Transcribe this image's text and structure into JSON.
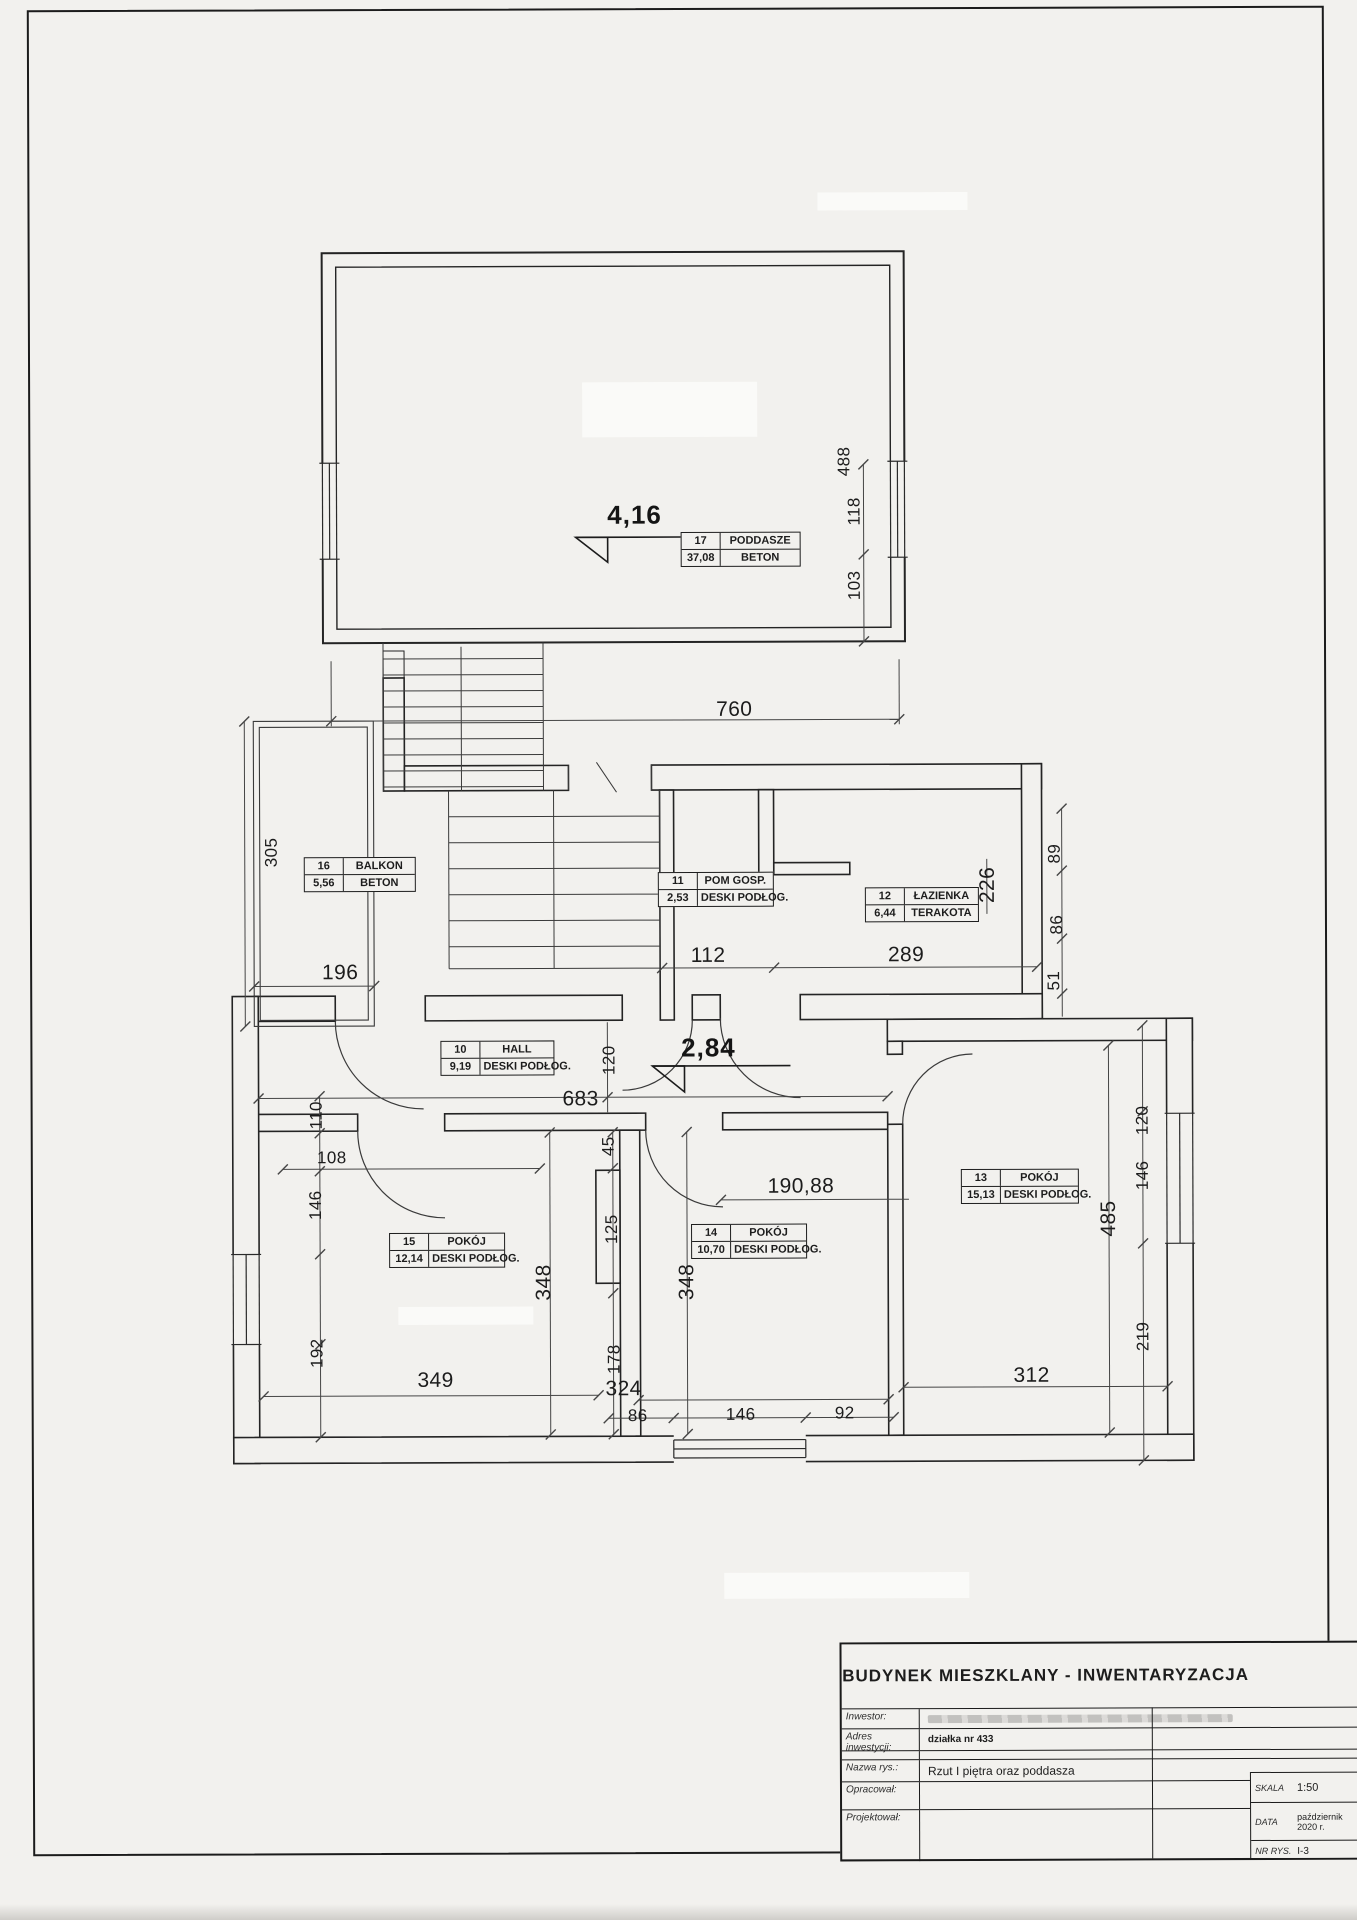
{
  "titleblock": {
    "title": "BUDYNEK  MIESZKLANY - INWENTARYZACJA",
    "rows": [
      {
        "label": "Inwestor:",
        "value": ""
      },
      {
        "label": "Adres inwestycji:",
        "value": "działka nr 433"
      },
      {
        "label": "Nazwa rys.:",
        "value": "Rzut  I piętra oraz poddasza"
      },
      {
        "label": "Opracował:",
        "value": ""
      },
      {
        "label": "Projektował:",
        "value": ""
      }
    ],
    "scale_label": "SKALA",
    "scale_value": "1:50",
    "date_label": "DATA",
    "date_value": "październik 2020 r.",
    "drawing_no_label": "NR RYS.",
    "drawing_no_value": "I-3"
  },
  "plan": {
    "rooms": [
      {
        "no": "17",
        "name": "PODDASZE",
        "area": "37,08",
        "floor": "BETON",
        "x": 650,
        "y": 522,
        "w": 118
      },
      {
        "no": "16",
        "name": "BALKON",
        "area": "5,56",
        "floor": "BETON",
        "x": 272,
        "y": 846,
        "w": 110
      },
      {
        "no": "11",
        "name": "POM GOSP.",
        "area": "2,53",
        "floor": "DESKI PODŁOG.",
        "x": 626,
        "y": 862,
        "w": 114
      },
      {
        "no": "12",
        "name": "ŁAZIENKA",
        "area": "6,44",
        "floor": "TERAKOTA",
        "x": 833,
        "y": 878,
        "w": 112
      },
      {
        "no": "10",
        "name": "HALL",
        "area": "9,19",
        "floor": "DESKI PODŁOG.",
        "x": 408,
        "y": 1030,
        "w": 112
      },
      {
        "no": "15",
        "name": "POKÓJ",
        "area": "12,14",
        "floor": "DESKI PODŁOG.",
        "x": 356,
        "y": 1222,
        "w": 114
      },
      {
        "no": "14",
        "name": "POKÓJ",
        "area": "10,70",
        "floor": "DESKI PODŁOG.",
        "x": 658,
        "y": 1214,
        "w": 114
      },
      {
        "no": "13",
        "name": "POKÓJ",
        "area": "15,13",
        "floor": "DESKI PODŁOG.",
        "x": 928,
        "y": 1160,
        "w": 116
      }
    ],
    "levels": [
      {
        "value": "4,16",
        "x": 604,
        "y": 505
      },
      {
        "value": "2,84",
        "x": 676,
        "y": 1038
      }
    ],
    "dims": [
      {
        "t": "488",
        "x": 814,
        "y": 452,
        "o": "v"
      },
      {
        "t": "118",
        "x": 824,
        "y": 502,
        "o": "v"
      },
      {
        "t": "103",
        "x": 824,
        "y": 576,
        "o": "v"
      },
      {
        "t": "760",
        "x": 703,
        "y": 700,
        "o": "h",
        "s": "md"
      },
      {
        "t": "305",
        "x": 240,
        "y": 841,
        "o": "v"
      },
      {
        "t": "196",
        "x": 308,
        "y": 962,
        "o": "h",
        "s": "md"
      },
      {
        "t": "112",
        "x": 676,
        "y": 946,
        "o": "h",
        "s": "md"
      },
      {
        "t": "289",
        "x": 874,
        "y": 946,
        "o": "h",
        "s": "md"
      },
      {
        "t": "226",
        "x": 956,
        "y": 876,
        "o": "v",
        "s": "md"
      },
      {
        "t": "89",
        "x": 1023,
        "y": 845,
        "o": "v"
      },
      {
        "t": "86",
        "x": 1025,
        "y": 916,
        "o": "v"
      },
      {
        "t": "51",
        "x": 1022,
        "y": 972,
        "o": "v"
      },
      {
        "t": "120",
        "x": 577,
        "y": 1050,
        "o": "v"
      },
      {
        "t": "683",
        "x": 548,
        "y": 1089,
        "o": "h",
        "s": "md"
      },
      {
        "t": "120",
        "x": 1110,
        "y": 1112,
        "o": "v"
      },
      {
        "t": "110",
        "x": 284,
        "y": 1104,
        "o": "v"
      },
      {
        "t": "108",
        "x": 299,
        "y": 1147,
        "o": "h"
      },
      {
        "t": "146",
        "x": 283,
        "y": 1194,
        "o": "v"
      },
      {
        "t": "192",
        "x": 284,
        "y": 1342,
        "o": "v"
      },
      {
        "t": "349",
        "x": 402,
        "y": 1370,
        "o": "h",
        "s": "md"
      },
      {
        "t": "348",
        "x": 511,
        "y": 1272,
        "o": "v",
        "s": "md"
      },
      {
        "t": "45",
        "x": 576,
        "y": 1136,
        "o": "v"
      },
      {
        "t": "125",
        "x": 579,
        "y": 1219,
        "o": "v"
      },
      {
        "t": "178",
        "x": 581,
        "y": 1349,
        "o": "v"
      },
      {
        "t": "324",
        "x": 590,
        "y": 1379,
        "o": "h",
        "s": "md"
      },
      {
        "t": "190,88",
        "x": 768,
        "y": 1177,
        "o": "h",
        "s": "md"
      },
      {
        "t": "348",
        "x": 654,
        "y": 1272,
        "o": "v",
        "s": "md"
      },
      {
        "t": "86",
        "x": 604,
        "y": 1406,
        "o": "h"
      },
      {
        "t": "146",
        "x": 707,
        "y": 1405,
        "o": "h"
      },
      {
        "t": "92",
        "x": 811,
        "y": 1404,
        "o": "h"
      },
      {
        "t": "312",
        "x": 998,
        "y": 1367,
        "o": "h",
        "s": "md"
      },
      {
        "t": "485",
        "x": 1076,
        "y": 1210,
        "o": "v",
        "s": "md"
      },
      {
        "t": "146",
        "x": 1110,
        "y": 1167,
        "o": "v"
      },
      {
        "t": "219",
        "x": 1110,
        "y": 1328,
        "o": "v"
      }
    ]
  }
}
